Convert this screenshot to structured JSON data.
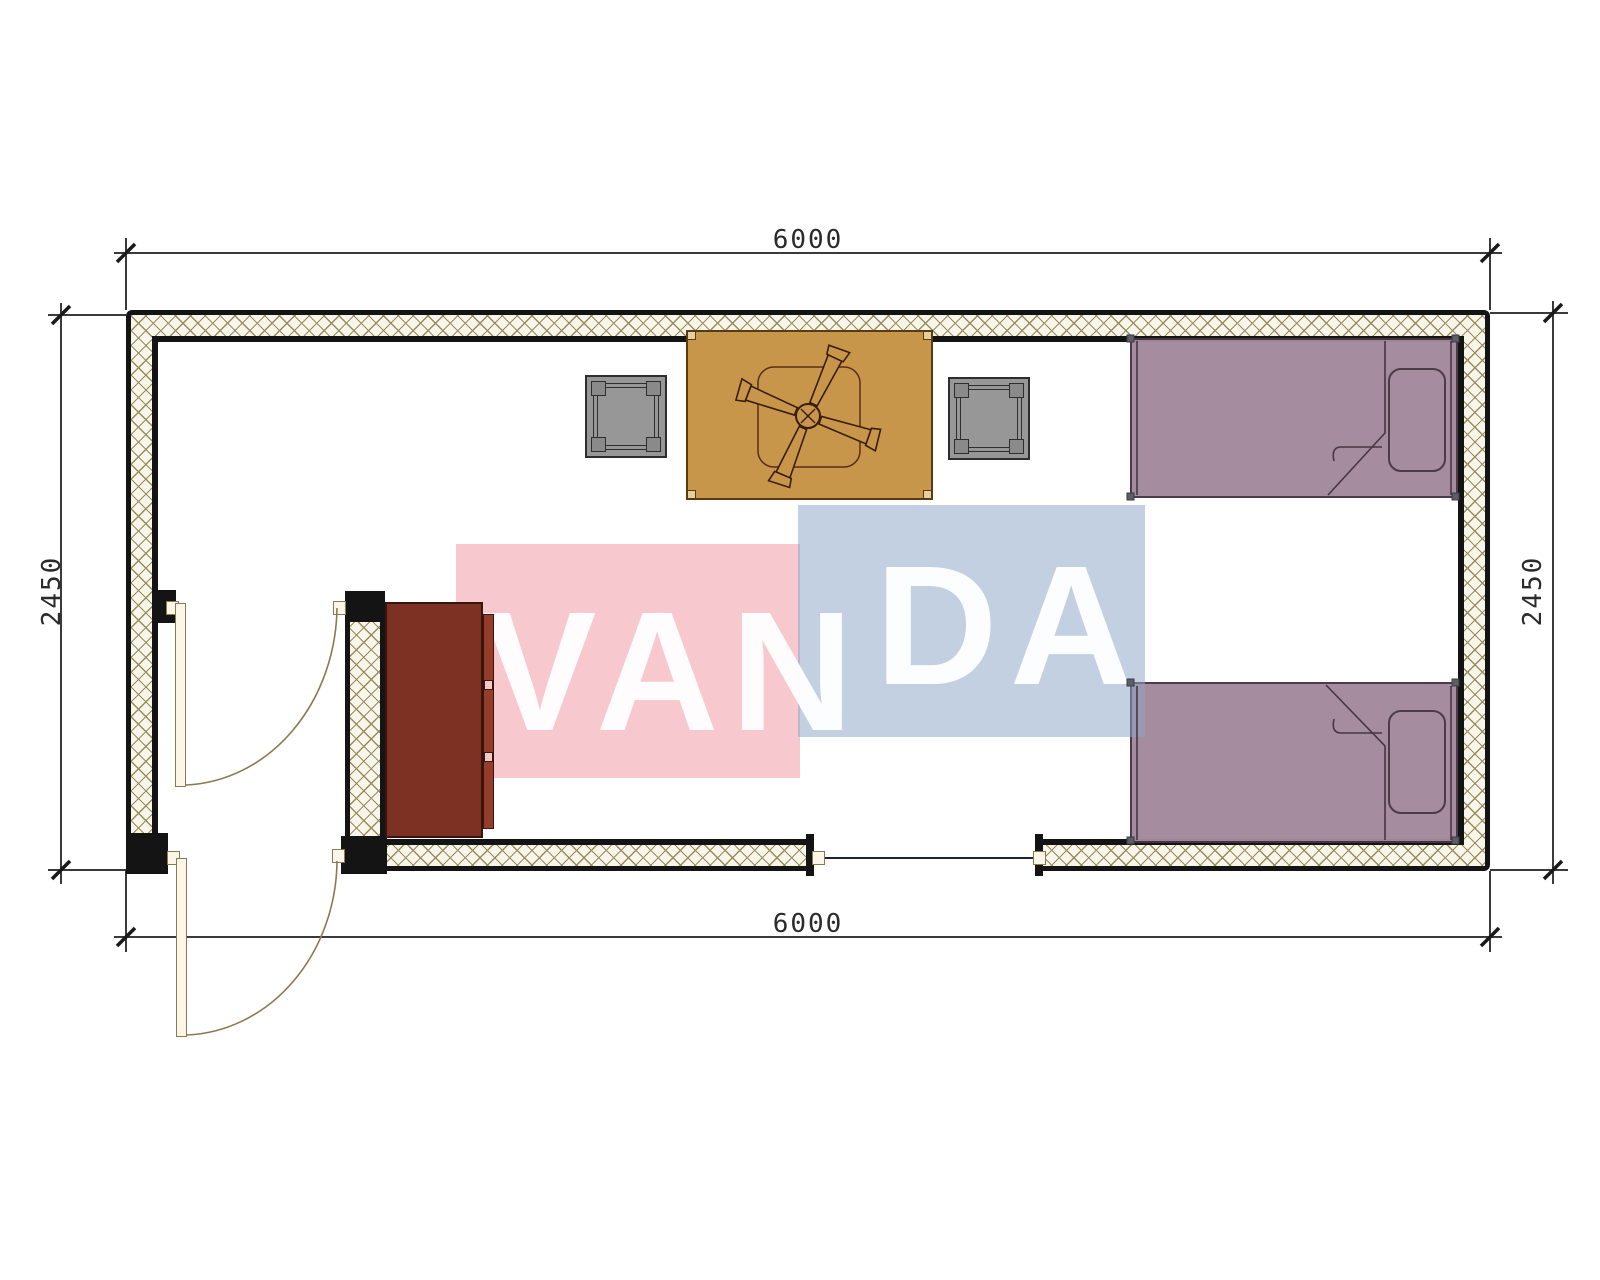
{
  "meta": {
    "drawing_type": "floor-plan",
    "units": "mm"
  },
  "dimensions": {
    "top": "6000",
    "bottom": "6000",
    "left": "2450",
    "right": "2450"
  },
  "watermark": {
    "full_text": "VANDA",
    "pink_part": "VAN",
    "blue_part": "DA",
    "pink_block_color": "#f8cdd2",
    "blue_block_color": "#c9d6e7"
  },
  "palette": {
    "wall_line": "#141414",
    "hatch_bg": "#f8f5e9",
    "hatch_line": "#968a5f",
    "dim_text": "#2b2b2b",
    "table": "#c8964b",
    "stool": "#979797",
    "bed": "#a3899b",
    "cabinet": "#7d3123",
    "cabinet_front": "#943d2a",
    "door_leaf": "#fbf6e8",
    "door_frame": "#8a7a50"
  },
  "furniture": [
    {
      "name": "single-bed-top"
    },
    {
      "name": "single-bed-bottom"
    },
    {
      "name": "dining-table"
    },
    {
      "name": "ceiling-fan"
    },
    {
      "name": "stool-left"
    },
    {
      "name": "stool-right"
    },
    {
      "name": "cabinet"
    },
    {
      "name": "interior-door"
    },
    {
      "name": "entrance-door"
    },
    {
      "name": "window"
    }
  ]
}
